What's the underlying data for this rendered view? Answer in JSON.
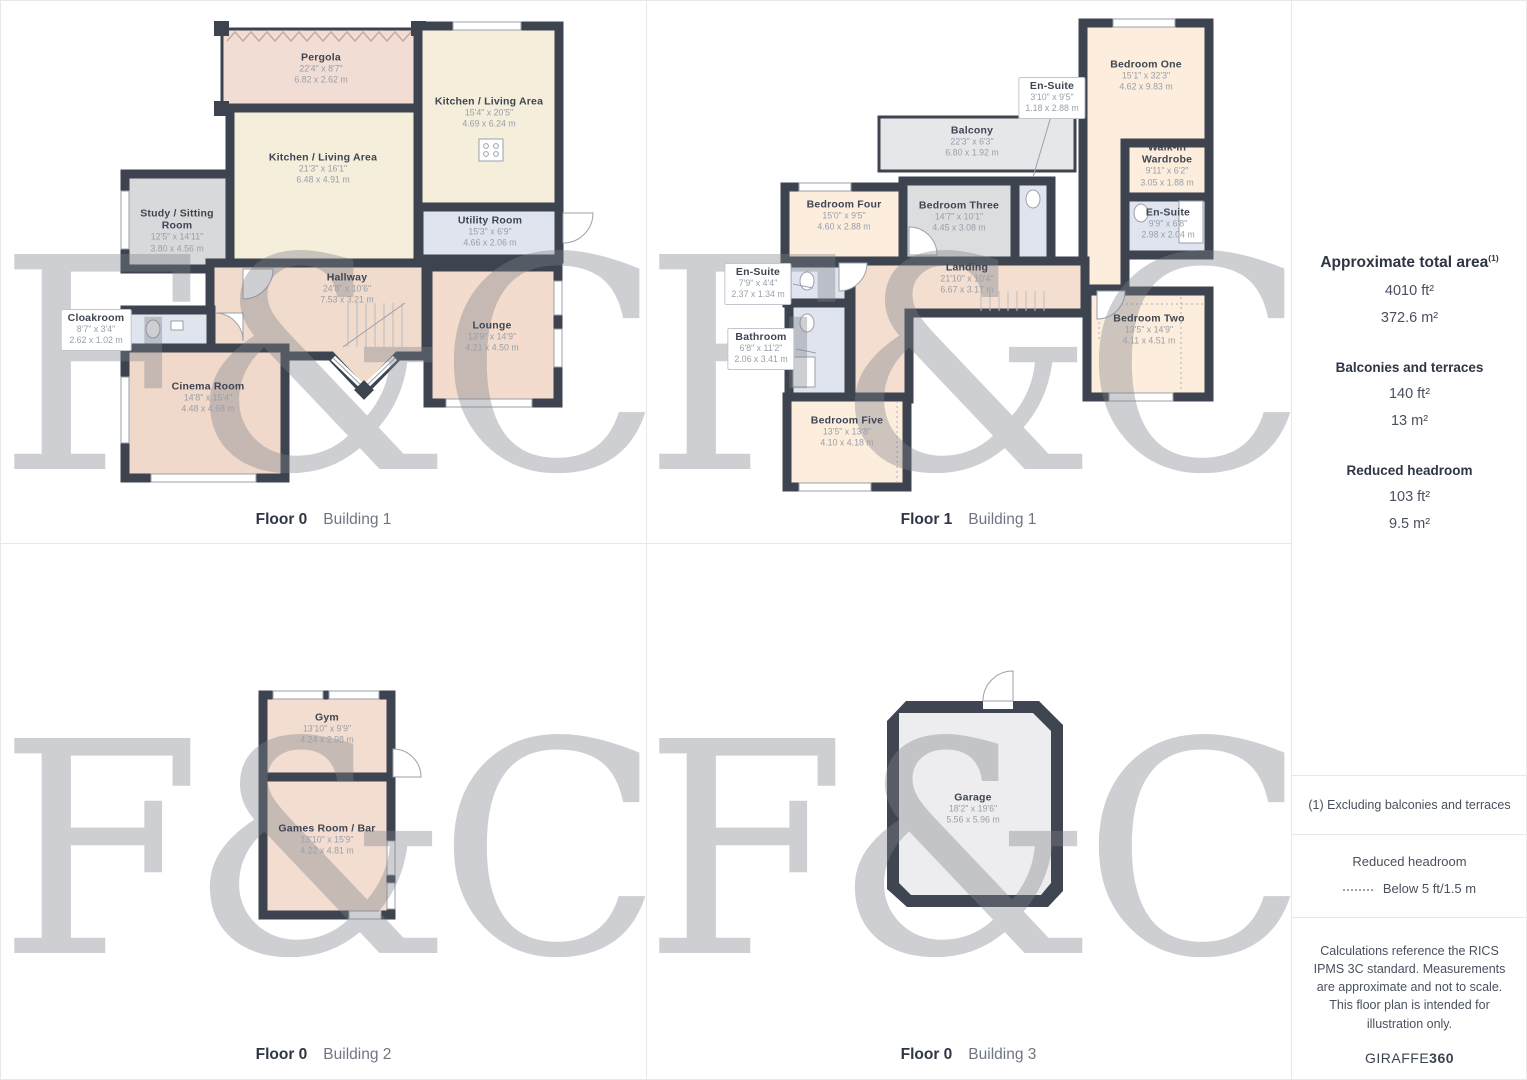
{
  "watermark": {
    "text": "F&C"
  },
  "colors": {
    "wall": "#3d444f",
    "cream": "#f4eedb",
    "peach": "#f2dcd0",
    "bedroom": "#fdeddd",
    "gray_room": "#d8d9da",
    "blue_room": "#dfe4ee",
    "balcony": "#e6e7e9",
    "name_text": "#3e4553",
    "dim_text": "#98a0aa"
  },
  "captions": [
    {
      "floor": "Floor 0",
      "building": "Building 1"
    },
    {
      "floor": "Floor 1",
      "building": "Building 1"
    },
    {
      "floor": "Floor 0",
      "building": "Building 2"
    },
    {
      "floor": "Floor 0",
      "building": "Building 3"
    }
  ],
  "plans": {
    "b1f0": {
      "rooms": [
        {
          "name": "Pergola",
          "imp": "22'4\" x 8'7\"",
          "met": "6.82 x 2.62 m"
        },
        {
          "name": "Kitchen / Living Area",
          "imp": "15'4\" x 20'5\"",
          "met": "4.69 x 6.24 m"
        },
        {
          "name": "Kitchen / Living Area",
          "imp": "21'3\" x 16'1\"",
          "met": "6.48 x 4.91 m"
        },
        {
          "name": "Study / Sitting Room",
          "imp": "12'5\" x 14'11\"",
          "met": "3.80 x 4.56 m"
        },
        {
          "name": "Cloakroom",
          "imp": "8'7\" x 3'4\"",
          "met": "2.62 x 1.02 m"
        },
        {
          "name": "Hallway",
          "imp": "24'8\" x 10'6\"",
          "met": "7.53 x 3.21 m"
        },
        {
          "name": "Utility Room",
          "imp": "15'3\" x 6'9\"",
          "met": "4.66 x 2.06 m"
        },
        {
          "name": "Lounge",
          "imp": "13'9\" x 14'9\"",
          "met": "4.21 x 4.50 m"
        },
        {
          "name": "Cinema Room",
          "imp": "14'8\" x 15'4\"",
          "met": "4.48 x 4.68 m"
        }
      ]
    },
    "b1f1": {
      "rooms": [
        {
          "name": "Bedroom One",
          "imp": "15'1\" x 32'3\"",
          "met": "4.62 x 9.83 m"
        },
        {
          "name": "En-Suite",
          "imp": "3'10\" x 9'5\"",
          "met": "1.18 x 2.88 m"
        },
        {
          "name": "Balcony",
          "imp": "22'3\" x 6'3\"",
          "met": "6.80 x 1.92 m"
        },
        {
          "name": "Walk-In Wardrobe",
          "imp": "9'11\" x 6'2\"",
          "met": "3.05 x 1.88 m"
        },
        {
          "name": "En-Suite",
          "imp": "9'9\" x 6'8\"",
          "met": "2.98 x 2.04 m"
        },
        {
          "name": "Bedroom Four",
          "imp": "15'0\" x 9'5\"",
          "met": "4.60 x 2.88 m"
        },
        {
          "name": "Bedroom Three",
          "imp": "14'7\" x 10'1\"",
          "met": "4.45 x 3.08 m"
        },
        {
          "name": "Landing",
          "imp": "21'10\" x 10'4\"",
          "met": "6.67 x 3.17 m"
        },
        {
          "name": "En-Suite",
          "imp": "7'9\" x 4'4\"",
          "met": "2.37 x 1.34 m"
        },
        {
          "name": "Bathroom",
          "imp": "6'8\" x 11'2\"",
          "met": "2.06 x 3.41 m"
        },
        {
          "name": "Bedroom Five",
          "imp": "13'5\" x 13'8\"",
          "met": "4.10 x 4.18 m"
        },
        {
          "name": "Bedroom Two",
          "imp": "13'5\" x 14'9\"",
          "met": "4.11 x 4.51 m"
        }
      ]
    },
    "b2f0": {
      "rooms": [
        {
          "name": "Gym",
          "imp": "13'10\" x 9'9\"",
          "met": "4.24 x 2.98 m"
        },
        {
          "name": "Games Room / Bar",
          "imp": "13'10\" x 15'9\"",
          "met": "4.22 x 4.81 m"
        }
      ]
    },
    "b3f0": {
      "rooms": [
        {
          "name": "Garage",
          "imp": "18'2\" x 19'6\"",
          "met": "5.56 x 5.96 m"
        }
      ]
    }
  },
  "sidebar": {
    "total": {
      "title": "Approximate total area",
      "sup": "(1)",
      "ft": "4010 ft²",
      "m": "372.6 m²"
    },
    "balconies": {
      "title": "Balconies and terraces",
      "ft": "140 ft²",
      "m": "13 m²"
    },
    "reduced": {
      "title": "Reduced headroom",
      "ft": "103 ft²",
      "m": "9.5 m²"
    },
    "footnote": "(1) Excluding balconies and terraces",
    "legend": {
      "title": "Reduced headroom",
      "label": "Below 5 ft/1.5 m"
    },
    "disclaimer": "Calculations reference the RICS IPMS 3C standard. Measurements are approximate and not to scale. This floor plan is intended for illustration only.",
    "brand": {
      "name": "GIRAFFE",
      "suffix": "360"
    }
  }
}
